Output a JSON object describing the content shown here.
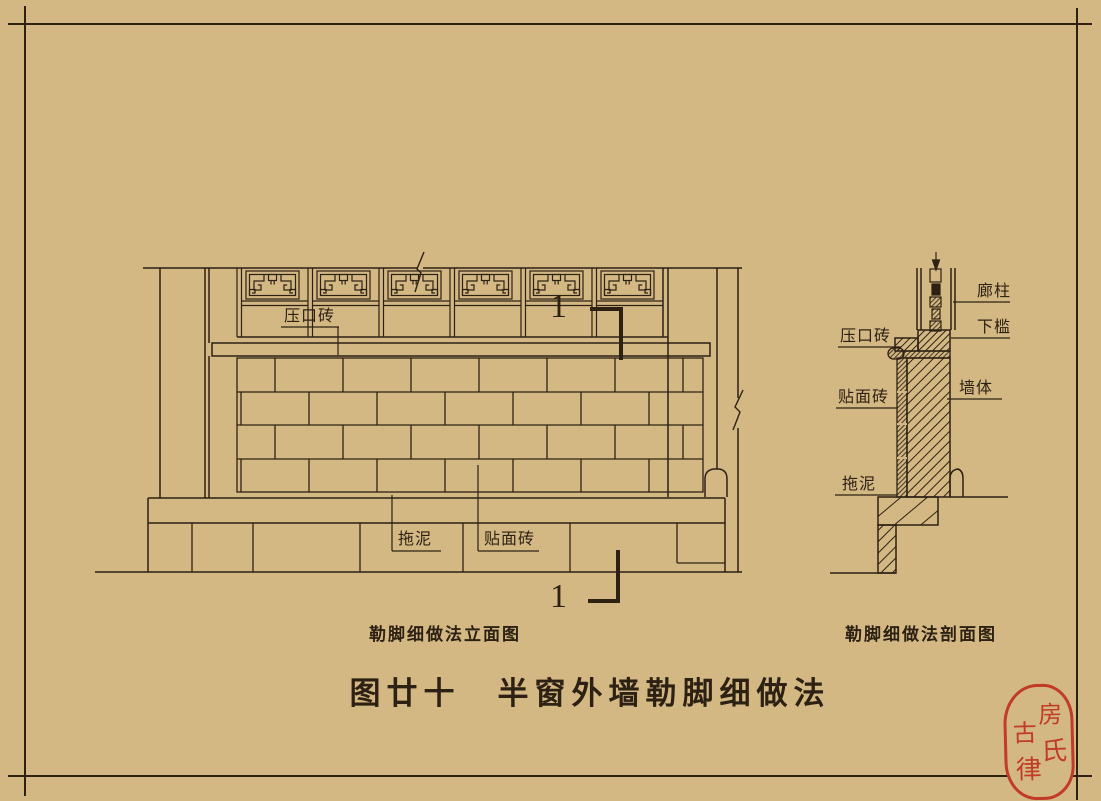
{
  "colors": {
    "background": "#d4b884",
    "line": "#2d2113",
    "seal": "#c13b27"
  },
  "title": "图廿十　半窗外墙勒脚细做法",
  "elevation": {
    "caption": "勒脚细做法立面图",
    "label_yakouzhuan": "压口砖",
    "label_tuoni": "拖泥",
    "label_tiemianzhuan": "贴面砖",
    "section_mark_top": "1",
    "section_mark_bottom": "1"
  },
  "section": {
    "caption": "勒脚细做法剖面图",
    "label_yakouzhuan": "压口砖",
    "label_tiemianzhuan": "贴面砖",
    "label_tuoni": "拖泥",
    "label_langzhu": "廊柱",
    "label_xiakan": "下槛",
    "label_qiangti": "墙体"
  },
  "seal": {
    "char_1": "房",
    "char_2": "氏",
    "char_3": "古",
    "char_4": "律"
  }
}
